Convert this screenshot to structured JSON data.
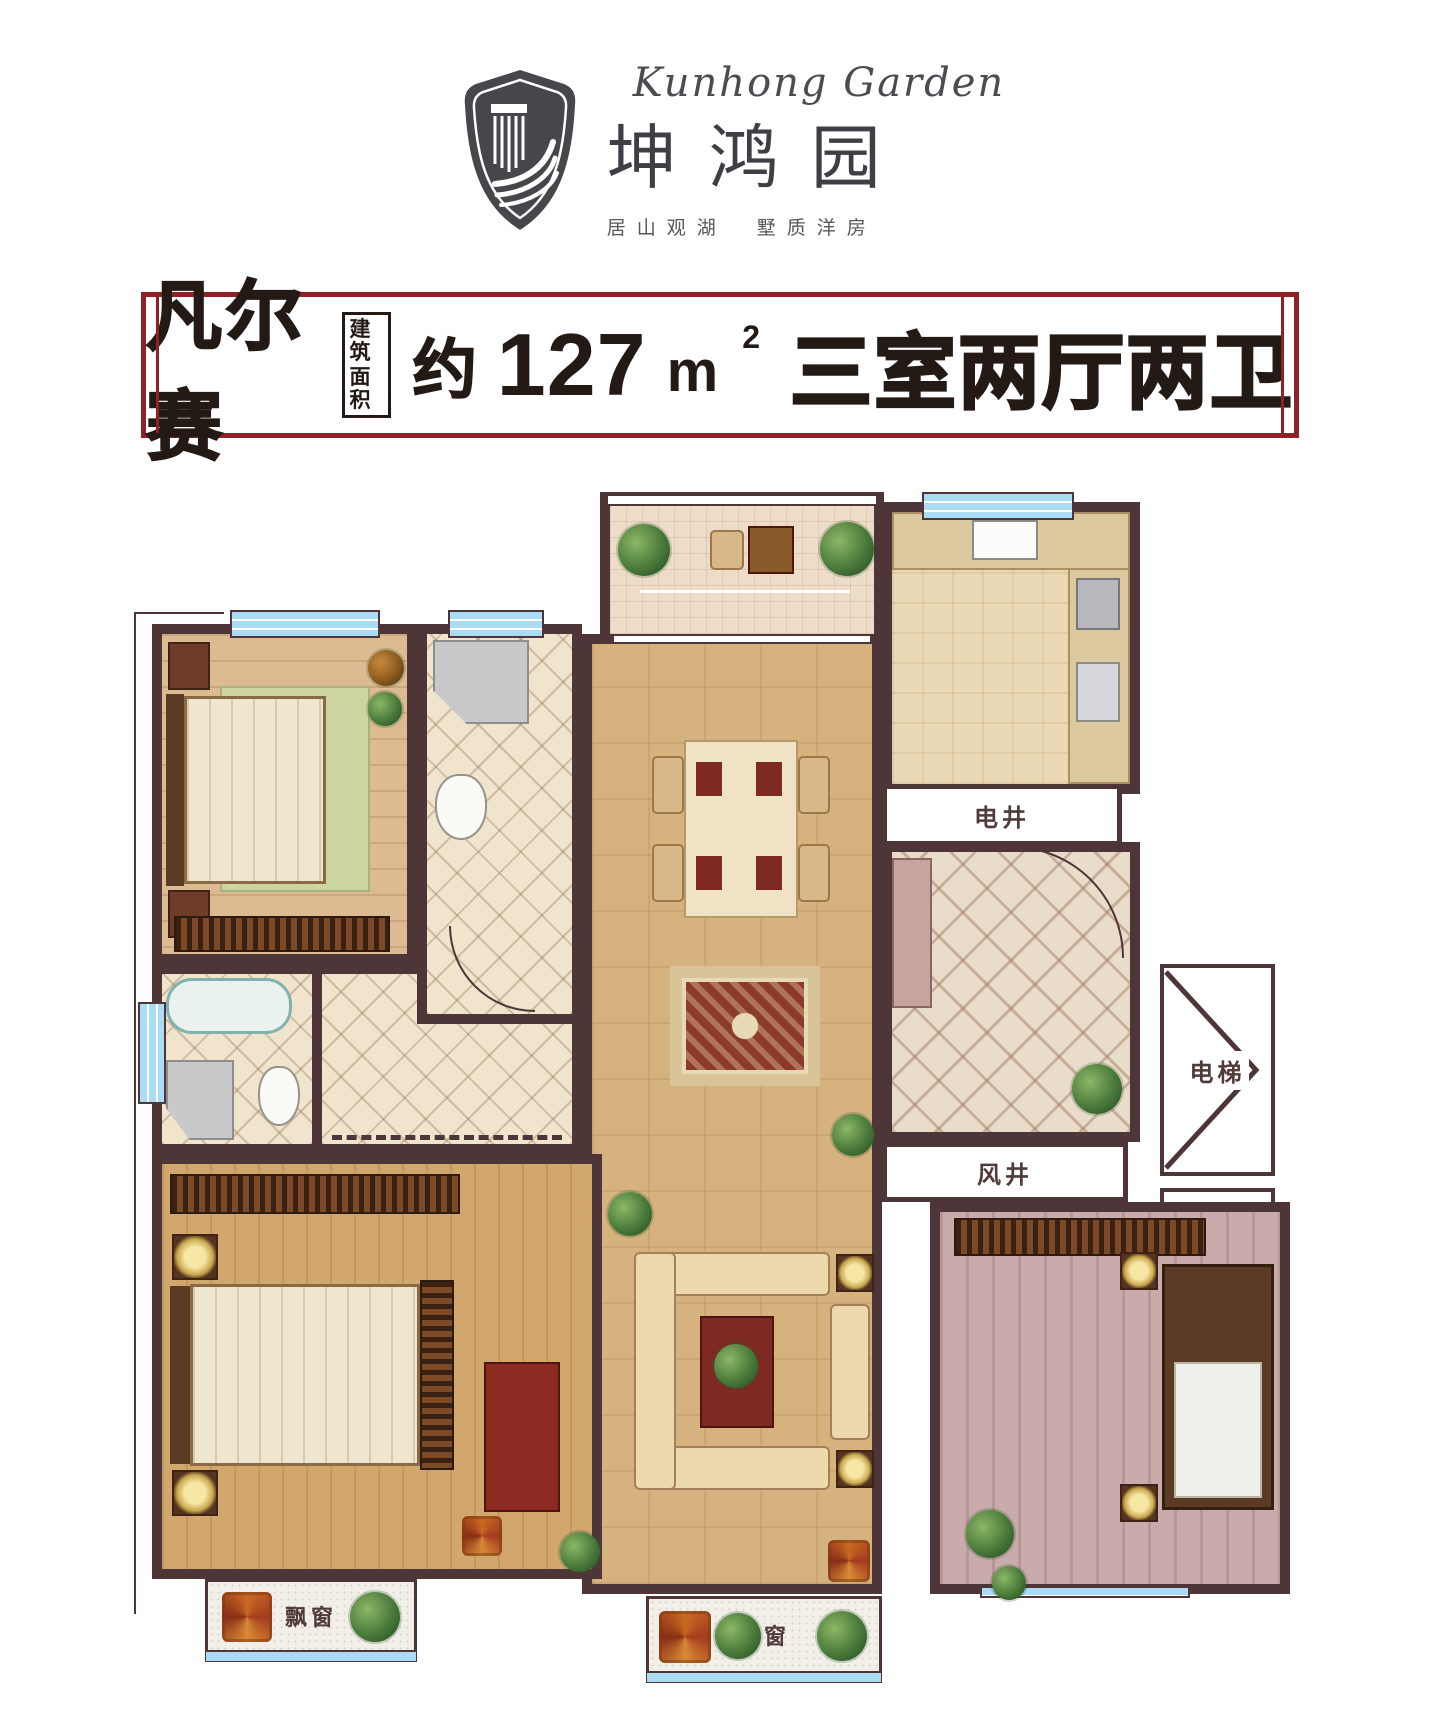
{
  "logo": {
    "brand_script": "Kunhong Garden",
    "brand_name": "坤鸿园",
    "tagline": "居山观湖　墅质洋房"
  },
  "banner": {
    "unit_name": "凡尔赛",
    "area_box_top": "建筑",
    "area_box_bottom": "面积",
    "area_approx": "约",
    "area_value": "127",
    "area_unit": "m",
    "area_exponent": "2",
    "rooms_text": "三室两厅两卫"
  },
  "plan": {
    "labels": {
      "electric_shaft": "电井",
      "elevator": "电梯",
      "wind_shaft": "风井",
      "bay_window_left": "飘窗",
      "bay_window_bottom": "飘窗"
    }
  },
  "colors": {
    "wall": "#4e3538",
    "banner_border": "#8e2227",
    "window_blue": "#aadcf5",
    "text_dark": "#241a15"
  }
}
